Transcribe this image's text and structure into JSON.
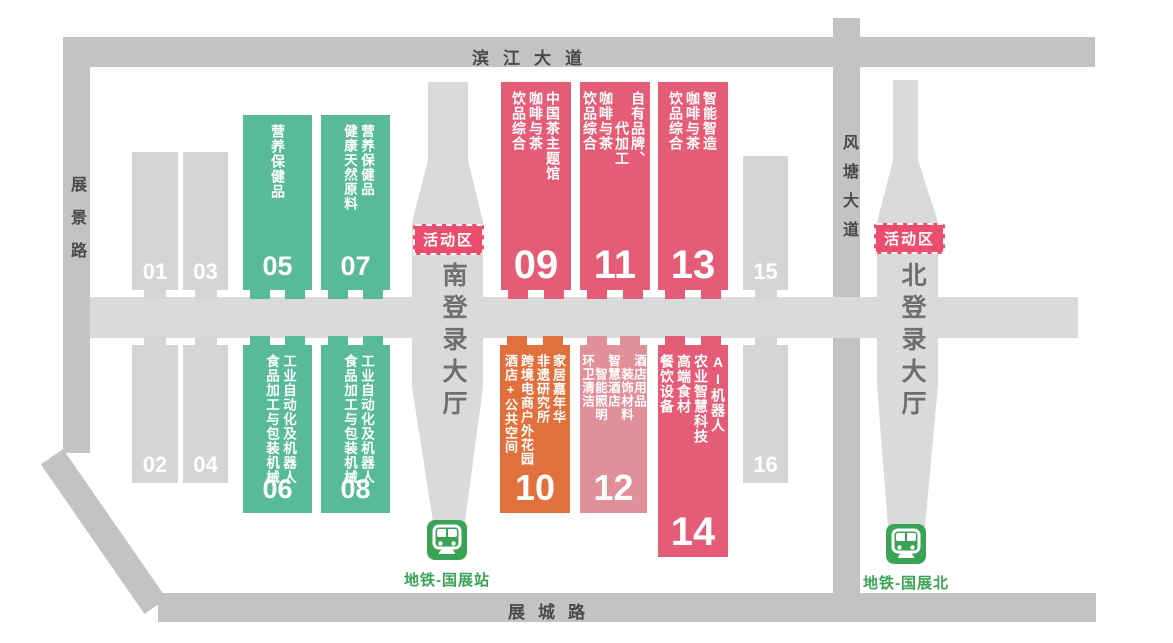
{
  "roads": {
    "top": "滨江大道",
    "left": "展景路",
    "right": "风塘大道",
    "bottom": "展城路"
  },
  "lobbies": {
    "south": {
      "name": "南登录大厅",
      "activity_label": "活动区",
      "metro": "地铁-国展站"
    },
    "north": {
      "name": "北登录大厅",
      "activity_label": "活动区",
      "metro": "地铁-国展北"
    }
  },
  "halls": [
    {
      "id": "01",
      "number": "01",
      "type": "gray",
      "row": "top",
      "lines": []
    },
    {
      "id": "03",
      "number": "03",
      "type": "gray",
      "row": "top",
      "lines": []
    },
    {
      "id": "05",
      "number": "05",
      "type": "green",
      "row": "top",
      "lines": [
        "营养保健品"
      ]
    },
    {
      "id": "07",
      "number": "07",
      "type": "green",
      "row": "top",
      "lines": [
        "营养保健品",
        "健康天然原料"
      ]
    },
    {
      "id": "09",
      "number": "09",
      "type": "red",
      "row": "top",
      "lines": [
        "中国茶主题馆",
        "咖啡与茶",
        "饮品综合"
      ]
    },
    {
      "id": "11",
      "number": "11",
      "type": "red",
      "row": "top",
      "lines": [
        "自有品牌、",
        "　　代加工",
        "咖啡与茶",
        "饮品综合"
      ]
    },
    {
      "id": "13",
      "number": "13",
      "type": "red",
      "row": "top",
      "lines": [
        "智能智造",
        "咖啡与茶",
        "饮品综合"
      ]
    },
    {
      "id": "15",
      "number": "15",
      "type": "gray",
      "row": "top",
      "lines": []
    },
    {
      "id": "02",
      "number": "02",
      "type": "gray",
      "row": "bottom",
      "lines": []
    },
    {
      "id": "04",
      "number": "04",
      "type": "gray",
      "row": "bottom",
      "lines": []
    },
    {
      "id": "06",
      "number": "06",
      "type": "green",
      "row": "bottom",
      "lines": [
        "工业自动化及机器人",
        "食品加工与包装机械"
      ]
    },
    {
      "id": "08",
      "number": "08",
      "type": "green",
      "row": "bottom",
      "lines": [
        "工业自动化及机器人",
        "食品加工与包装机械"
      ]
    },
    {
      "id": "10",
      "number": "10",
      "type": "orange",
      "row": "bottom",
      "lines": [
        "家居嘉年华",
        "非遗研究所",
        "跨境电商户外花园",
        "酒店+公共空间"
      ]
    },
    {
      "id": "12",
      "number": "12",
      "type": "pink",
      "row": "bottom",
      "lines": [
        "酒店用品",
        "　装饰材料",
        "智慧酒店",
        "　智能照明",
        "环卫清洁"
      ]
    },
    {
      "id": "14",
      "number": "14",
      "type": "red",
      "row": "bottom",
      "lines": [
        "AI机器人",
        "农业智慧科技",
        "高端食材",
        "餐饮设备"
      ]
    },
    {
      "id": "16",
      "number": "16",
      "type": "gray",
      "row": "bottom",
      "lines": []
    }
  ],
  "colors": {
    "hall_green": "#58b99b",
    "hall_red": "#e55c77",
    "hall_orange": "#e1703d",
    "hall_pink": "#e18f98",
    "hall_gray": "#d5d5d7",
    "road": "#c3c3c5",
    "corridor": "#dadadb",
    "activity_badge": "#ea4d6d",
    "metro_green": "#3aa355",
    "road_text": "#4a4a4c",
    "lobby_text": "#6f6f71"
  }
}
